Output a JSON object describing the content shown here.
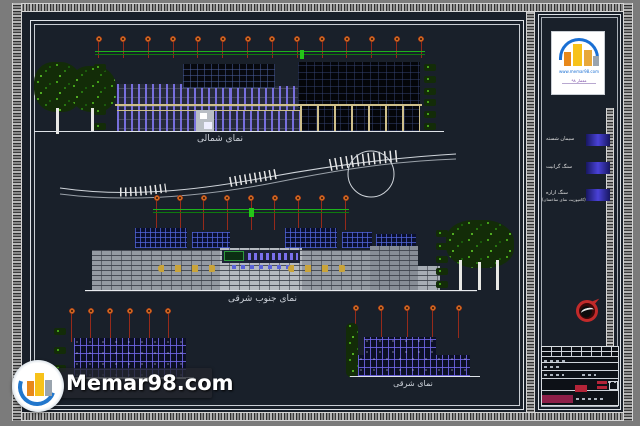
{
  "sheet": {
    "outer_bg": "#7b7b7b",
    "paper_bg": "#19202a",
    "frame_color": "#dfe3e8"
  },
  "elevations": {
    "north": {
      "title": "نمای شمالی"
    },
    "southeast": {
      "title": "نمای جنوب شرقی"
    },
    "east": {
      "title": "نمای شرقی"
    }
  },
  "legend": {
    "items": [
      {
        "label": "سیمان شسته",
        "swatch": "#4a42d8"
      },
      {
        "label": "سنگ گرانیت",
        "swatch": "#4a42d8"
      },
      {
        "label": "سنگ ازاره",
        "sublabel": "(کامپوزیت نمای ساختمان)",
        "swatch": "#4a42d8"
      }
    ]
  },
  "logo_box": {
    "site_text": "www.memar98.com",
    "caption": "معمار ۹۸"
  },
  "watermark": {
    "text": "Memar98.com"
  },
  "colors": {
    "green_line": "#1db31d",
    "light_pole": "#962a1a",
    "light_knob": "#cf6a22",
    "window_purple": "#7a70ee",
    "canopy_tan": "#cfc08a",
    "panel_blue_grid": "#3346a0",
    "brick_gray": "#949aa2",
    "compass_red": "#c22a2a",
    "crimson_cell": "#8e1f48"
  }
}
